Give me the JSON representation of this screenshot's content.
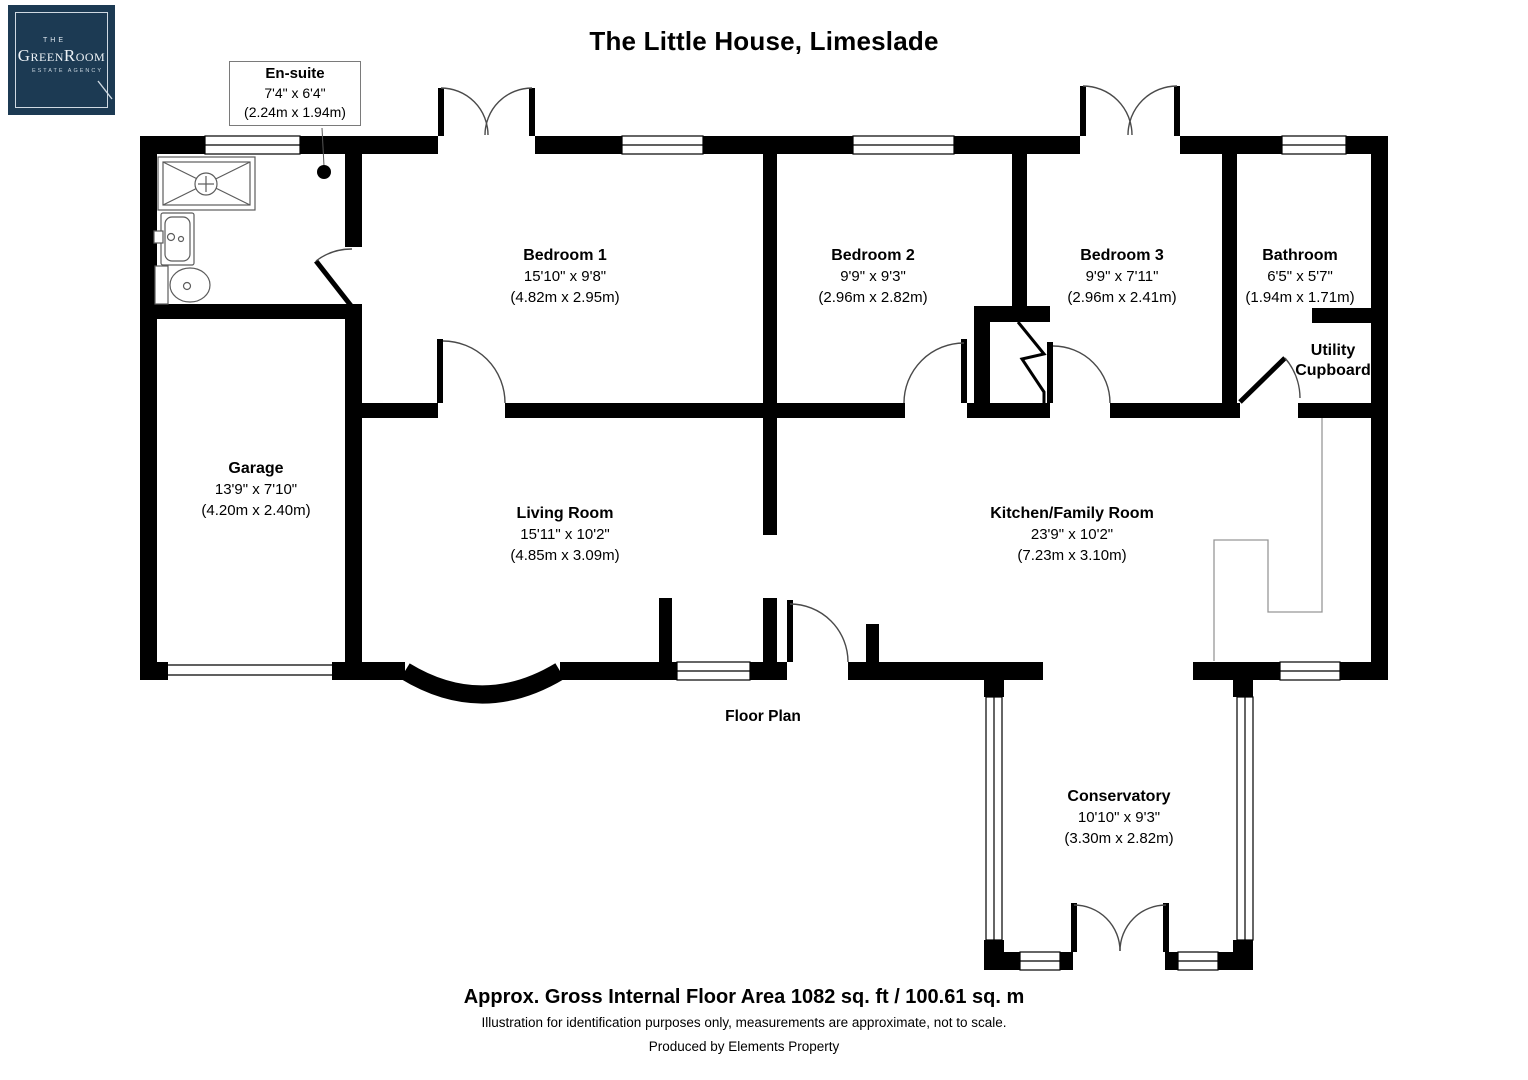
{
  "title": "The Little House, Limeslade",
  "logo": {
    "the": "THE",
    "name": "GreenRoom",
    "tagline": "ESTATE AGENCY"
  },
  "colors": {
    "logo_navy": "#1c3a53",
    "wall": "#000000"
  },
  "rooms": {
    "ensuite": {
      "name": "En-suite",
      "imperial": "7'4\" x 6'4\"",
      "metric": "(2.24m x 1.94m)"
    },
    "bedroom1": {
      "name": "Bedroom 1",
      "imperial": "15'10\" x 9'8\"",
      "metric": "(4.82m x 2.95m)"
    },
    "bedroom2": {
      "name": "Bedroom 2",
      "imperial": "9'9\" x 9'3\"",
      "metric": "(2.96m x 2.82m)"
    },
    "bedroom3": {
      "name": "Bedroom 3",
      "imperial": "9'9\" x 7'11\"",
      "metric": "(2.96m x 2.41m)"
    },
    "bathroom": {
      "name": "Bathroom",
      "imperial": "6'5\" x 5'7\"",
      "metric": "(1.94m x 1.71m)"
    },
    "utility": {
      "line1": "Utility",
      "line2": "Cupboard"
    },
    "garage": {
      "name": "Garage",
      "imperial": "13'9\" x 7'10\"",
      "metric": "(4.20m x 2.40m)"
    },
    "living": {
      "name": "Living Room",
      "imperial": "15'11\" x 10'2\"",
      "metric": "(4.85m x 3.09m)"
    },
    "kitchen": {
      "name": "Kitchen/Family Room",
      "imperial": "23'9\" x 10'2\"",
      "metric": "(7.23m x 3.10m)"
    },
    "conservatory": {
      "name": "Conservatory",
      "imperial": "10'10\" x 9'3\"",
      "metric": "(3.30m x 2.82m)"
    }
  },
  "captions": {
    "floor_plan": "Floor Plan",
    "area": "Approx. Gross Internal Floor Area 1082 sq. ft / 100.61 sq. m",
    "disclaimer": "Illustration for identification purposes only, measurements are approximate, not to scale.",
    "producer": "Produced by Elements Property"
  }
}
